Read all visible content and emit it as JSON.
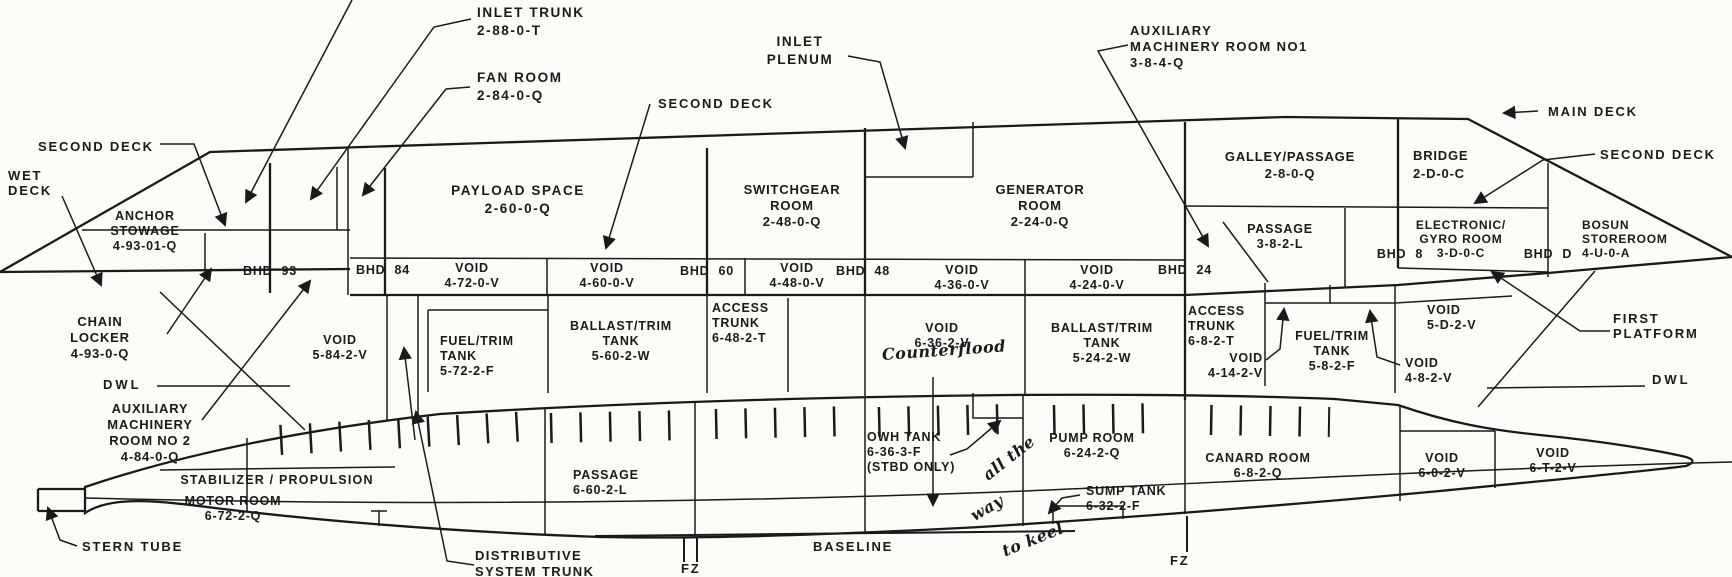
{
  "title": "Ship inboard profile compartment diagram",
  "ink": "#1a1a1a",
  "paper": "#fbfbf8",
  "decks": {
    "second_deck_left": "SECOND DECK",
    "wet_deck": [
      "WET",
      "DECK"
    ],
    "second_deck_center": "SECOND DECK",
    "main_deck": "MAIN DECK",
    "second_deck_right": "SECOND DECK",
    "first_platform": [
      "FIRST",
      "PLATFORM"
    ],
    "dwl_left": "DWL",
    "dwl_right": "DWL",
    "baseline": "BASELINE",
    "fz_left": "FZ",
    "fz_right": "FZ"
  },
  "callouts": {
    "inlet_trunk": [
      "INLET TRUNK",
      "2-88-0-T"
    ],
    "fan_room": [
      "FAN ROOM",
      "2-84-0-Q"
    ],
    "inlet_plenum": [
      "INLET",
      "PLENUM"
    ],
    "aux_machinery_room_no1": [
      "AUXILIARY",
      "MACHINERY ROOM NO1",
      "3-8-4-Q"
    ],
    "chain_locker": [
      "CHAIN",
      "LOCKER",
      "4-93-0-Q"
    ],
    "aux_machinery_room_no2": [
      "AUXILIARY",
      "MACHINERY",
      "ROOM NO 2",
      "4-84-0-Q"
    ],
    "stern_tube": "STERN TUBE",
    "distributive_system_trunk": [
      "DISTRIBUTIVE",
      "SYSTEM TRUNK"
    ]
  },
  "bulkheads": {
    "b93": [
      "BHD",
      "93"
    ],
    "b84": [
      "BHD",
      "84"
    ],
    "b60": [
      "BHD",
      "60"
    ],
    "b48": [
      "BHD",
      "48"
    ],
    "b24": [
      "BHD",
      "24"
    ],
    "b8": [
      "BHD",
      "8"
    ],
    "bd": [
      "BHD",
      "D"
    ]
  },
  "compartments": {
    "anchor_stowage": [
      "ANCHOR",
      "STOWAGE",
      "4-93-01-Q"
    ],
    "payload_space": [
      "PAYLOAD SPACE",
      "2-60-0-Q"
    ],
    "switchgear_room": [
      "SWITCHGEAR",
      "ROOM",
      "2-48-0-Q"
    ],
    "generator_room": [
      "GENERATOR",
      "ROOM",
      "2-24-0-Q"
    ],
    "galley_passage": [
      "GALLEY/PASSAGE",
      "2-8-0-Q"
    ],
    "bridge": [
      "BRIDGE",
      "2-D-0-C"
    ],
    "passage_382l": [
      "PASSAGE",
      "3-8-2-L"
    ],
    "electronic_gyro_room": [
      "ELECTRONIC/",
      "GYRO ROOM",
      "3-D-0-C"
    ],
    "bosun_storeroom": [
      "BOSUN",
      "STOREROOM",
      "4-U-0-A"
    ],
    "void_4720": [
      "VOID",
      "4-72-0-V"
    ],
    "void_4600": [
      "VOID",
      "4-60-0-V"
    ],
    "void_4480": [
      "VOID",
      "4-48-0-V"
    ],
    "void_4360": [
      "VOID",
      "4-36-0-V"
    ],
    "void_4240": [
      "VOID",
      "4-24-0-V"
    ],
    "void_5842": [
      "VOID",
      "5-84-2-V"
    ],
    "fuel_trim_5722": [
      "FUEL/TRIM",
      "TANK",
      "5-72-2-F"
    ],
    "ballast_trim_5602": [
      "BALLAST/TRIM",
      "TANK",
      "5-60-2-W"
    ],
    "access_trunk_6482": [
      "ACCESS",
      "TRUNK",
      "6-48-2-T"
    ],
    "void_6362": [
      "VOID",
      "6-36-2-V"
    ],
    "ballast_trim_5242": [
      "BALLAST/TRIM",
      "TANK",
      "5-24-2-W"
    ],
    "access_trunk_682": [
      "ACCESS",
      "TRUNK",
      "6-8-2-T"
    ],
    "void_4142": [
      "VOID",
      "4-14-2-V"
    ],
    "fuel_trim_582": [
      "FUEL/TRIM",
      "TANK",
      "5-8-2-F"
    ],
    "void_5d2": [
      "VOID",
      "5-D-2-V"
    ],
    "void_482": [
      "VOID",
      "4-8-2-V"
    ],
    "motor_room_line1": "STABILIZER / PROPULSION",
    "motor_room_rest": [
      "MOTOR ROOM",
      "6-72-2-Q"
    ],
    "passage_6602": [
      "PASSAGE",
      "6-60-2-L"
    ],
    "owh_tank": [
      "OWH TANK",
      "6-36-3-F",
      "(STBD ONLY)"
    ],
    "pump_room": [
      "PUMP ROOM",
      "6-24-2-Q"
    ],
    "sump_tank": [
      "SUMP TANK",
      "6-32-2-F"
    ],
    "canard_room": [
      "CANARD ROOM",
      "6-8-2-Q"
    ],
    "void_602": [
      "VOID",
      "6-0-2-V"
    ],
    "void_6t2": [
      "VOID",
      "6-T-2-V"
    ]
  },
  "handwriting": {
    "counterflood": "Counterflood",
    "note1": "all the",
    "note2": "way",
    "note3": "to keel"
  }
}
